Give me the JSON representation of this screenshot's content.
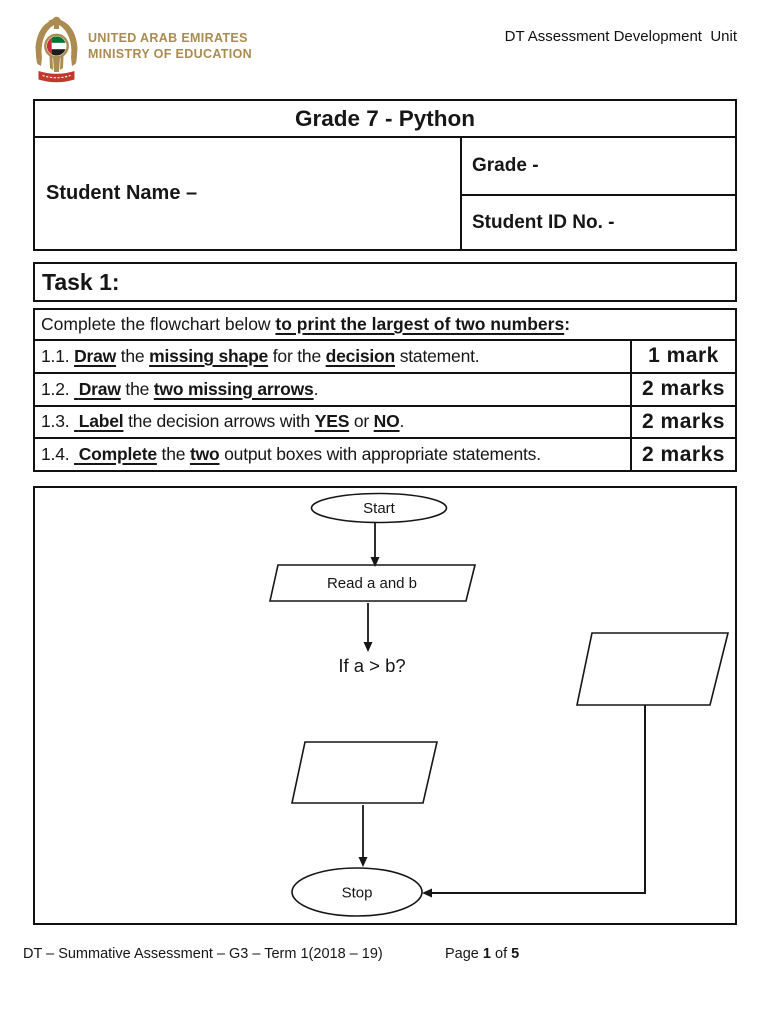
{
  "header": {
    "ministry_line1": "UNITED ARAB EMIRATES",
    "ministry_line2": "MINISTRY OF EDUCATION",
    "unit_title": "DT Assessment Development  Unit",
    "emblem_icon": "uae-ministry-of-education-falcon-emblem"
  },
  "info_table": {
    "title": "Grade 7 - Python",
    "student_name_label": "Student Name –",
    "grade_label": "Grade -",
    "student_id_label": "Student ID No. -"
  },
  "task": {
    "heading": "Task 1:",
    "intro_runs": [
      {
        "t": "Complete the flowchart below "
      },
      {
        "t": "to print the largest of two numbers",
        "b": true,
        "u": true
      },
      {
        "t": ":",
        "b": true
      }
    ],
    "rows": [
      {
        "runs": [
          {
            "t": "1.1. "
          },
          {
            "t": "Draw",
            "b": true,
            "u": true
          },
          {
            "t": " the "
          },
          {
            "t": "missing shape",
            "b": true,
            "u": true
          },
          {
            "t": " for the "
          },
          {
            "t": "decision",
            "b": true,
            "u": true
          },
          {
            "t": " statement."
          }
        ],
        "marks": "1 mark"
      },
      {
        "runs": [
          {
            "t": "1.2. "
          },
          {
            "t": " Draw",
            "b": true,
            "u": true
          },
          {
            "t": " the "
          },
          {
            "t": "two missing arrows",
            "b": true,
            "u": true
          },
          {
            "t": "."
          }
        ],
        "marks": "2 marks"
      },
      {
        "runs": [
          {
            "t": "1.3. "
          },
          {
            "t": " Label",
            "b": true,
            "u": true
          },
          {
            "t": " the decision arrows with "
          },
          {
            "t": "YES",
            "b": true,
            "u": true
          },
          {
            "t": " or "
          },
          {
            "t": "NO",
            "b": true,
            "u": true
          },
          {
            "t": "."
          }
        ],
        "marks": "2 marks"
      },
      {
        "runs": [
          {
            "t": "1.4. "
          },
          {
            "t": " Complete",
            "b": true,
            "u": true
          },
          {
            "t": " the "
          },
          {
            "t": "two",
            "b": true,
            "u": true
          },
          {
            "t": " output boxes with appropriate statements."
          }
        ],
        "marks": "2 marks"
      }
    ]
  },
  "flowchart": {
    "start_label": "Start",
    "read_label": "Read a and b",
    "decision_label": "If a > b?",
    "stop_label": "Stop"
  },
  "footer": {
    "left_text": "DT – Summative Assessment – G3 – Term 1(2018 – 19)",
    "page_runs": [
      {
        "t": "Page "
      },
      {
        "t": "1",
        "b": true
      },
      {
        "t": " of "
      },
      {
        "t": "5",
        "b": true
      }
    ]
  },
  "colors": {
    "text": "#161616",
    "border": "#111111",
    "logo_gold": "#ab8b50",
    "ribbon_red": "#bf3a2b",
    "flag_red": "#ce2b37",
    "flag_green": "#00732f",
    "flag_black": "#1d1d1b"
  }
}
